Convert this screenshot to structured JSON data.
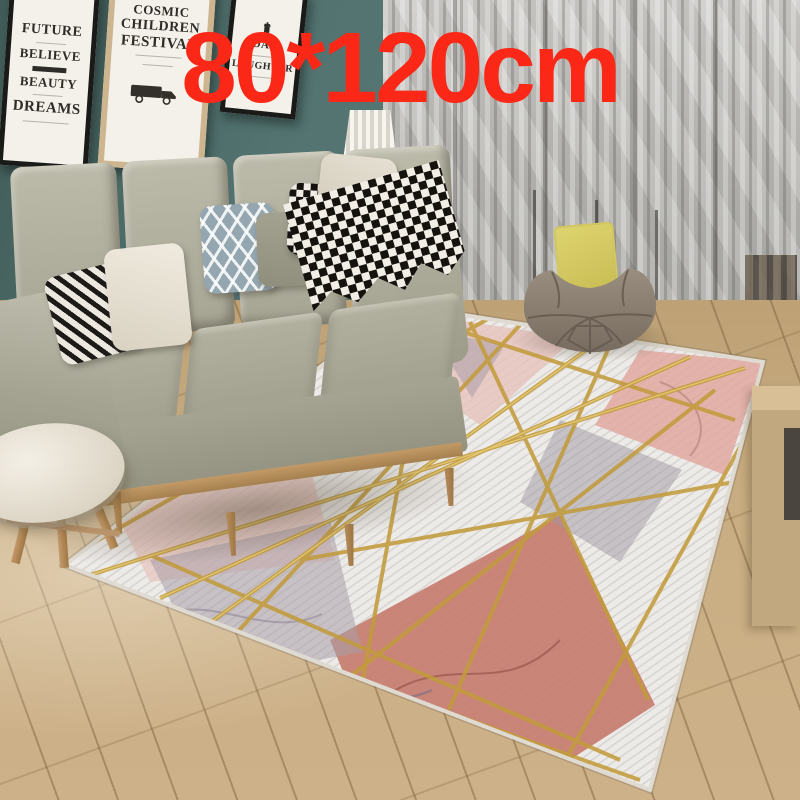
{
  "overlay": {
    "text": "80*120cm",
    "color": "#fb2817"
  },
  "posters": [
    {
      "title": "future-quote",
      "frame_color": "#1a1a18",
      "lines": [
        "FUTURE",
        "BELIEVE",
        "BEAUTY",
        "DREAMS"
      ]
    },
    {
      "title": "cosmic-children-festival",
      "frame_color": "#cdb68f",
      "lines": [
        "COSMIC",
        "CHILDREN",
        "FESTIVAL"
      ],
      "icon": "vintage-truck-icon"
    },
    {
      "title": "day-laughter",
      "frame_color": "#1a1a18",
      "lines": [
        "DAY",
        "LAUGHTER"
      ],
      "icon": "tower-icon"
    }
  ],
  "palette": {
    "wall": "#577471",
    "curtain": "#b6b5b1",
    "floor": "#c9ad82",
    "sofa": "#a9a795",
    "rug_base": "#edebe8",
    "rug_gold": "#c29b3c",
    "rug_pink": "#e5bfb8",
    "rug_rose": "#c57a6d",
    "rug_gray": "#a29aa5",
    "beanbag": "#8b8073",
    "beanbag_pillow": "#d7cc67",
    "overlay_red": "#fb2817"
  }
}
